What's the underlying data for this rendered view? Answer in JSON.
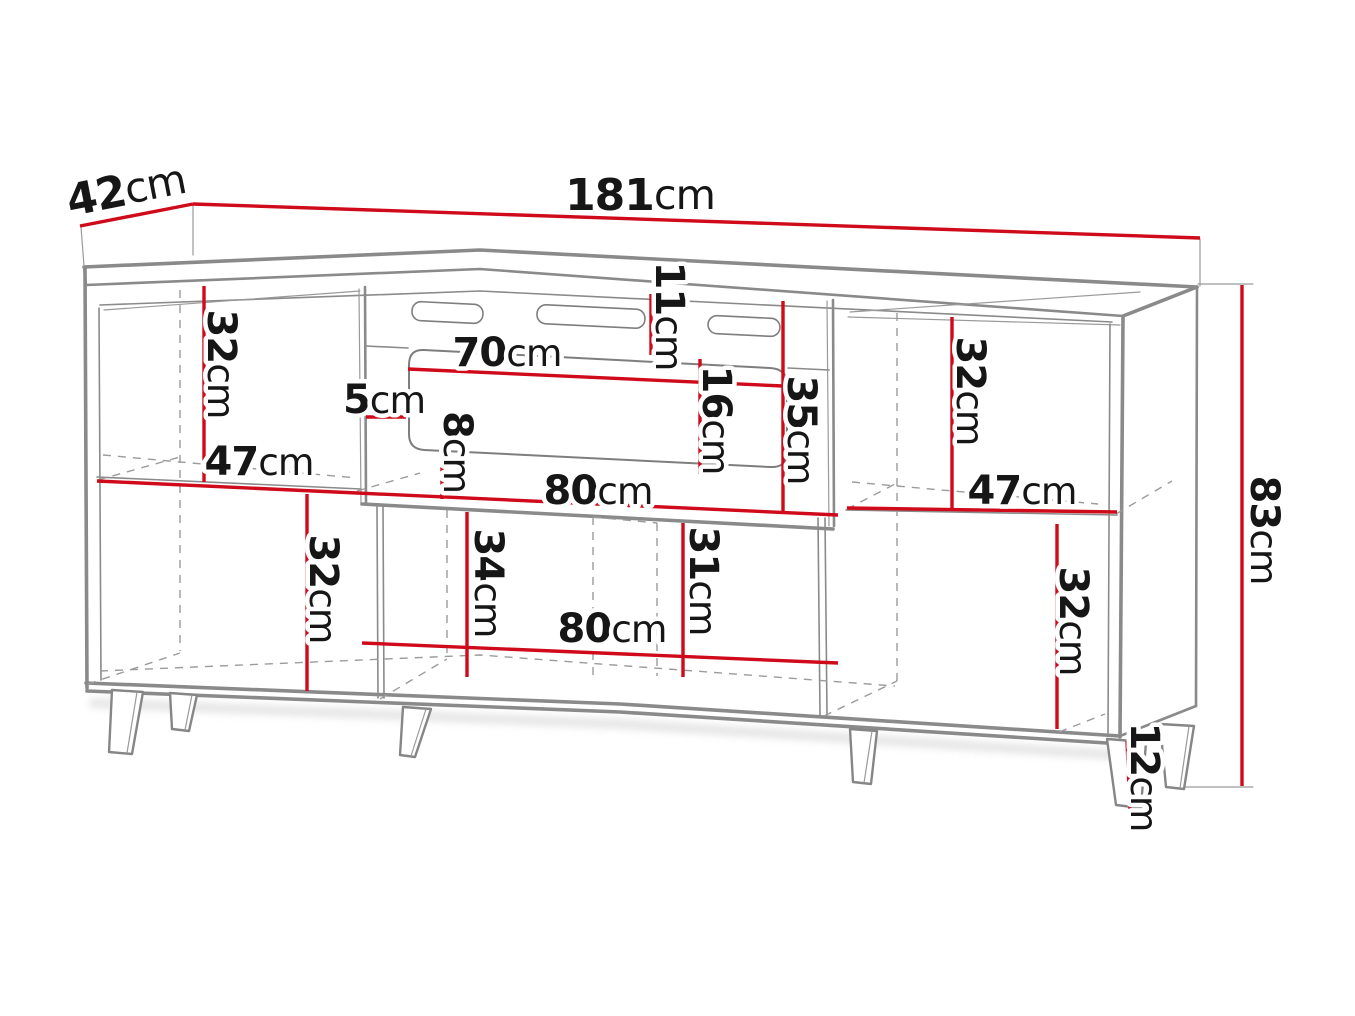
{
  "meta": {
    "type": "furniture-dimension-diagram",
    "subject": "sideboard / TV cabinet with fireplace insert, six tapered legs",
    "unit": "cm",
    "view": "front three-quarter perspective line drawing"
  },
  "colors": {
    "dimension_line": "#cf0a1a",
    "structure_line": "#8a8a8a",
    "label_text": "#161616",
    "background": "#ffffff"
  },
  "overall_dimensions": {
    "width_cm": 181,
    "depth_cm": 42,
    "height_cm": 83,
    "leg_height_cm": 12
  },
  "labels": [
    {
      "id": "depth",
      "value": "42",
      "unit": "cm"
    },
    {
      "id": "width",
      "value": "181",
      "unit": "cm"
    },
    {
      "id": "height",
      "value": "83",
      "unit": "cm"
    },
    {
      "id": "leg-height",
      "value": "12",
      "unit": "cm"
    },
    {
      "id": "left-upper-compartment",
      "value": "32",
      "unit": "cm"
    },
    {
      "id": "left-shelf-width",
      "value": "47",
      "unit": "cm"
    },
    {
      "id": "left-lower-compartment",
      "value": "32",
      "unit": "cm"
    },
    {
      "id": "side-gap",
      "value": "5",
      "unit": "cm"
    },
    {
      "id": "bottom-gap",
      "value": "8",
      "unit": "cm"
    },
    {
      "id": "fireplace-top-width",
      "value": "70",
      "unit": "cm"
    },
    {
      "id": "vent-band-height",
      "value": "11",
      "unit": "cm"
    },
    {
      "id": "fireplace-opening-height",
      "value": "16",
      "unit": "cm"
    },
    {
      "id": "middle-section-height",
      "value": "35",
      "unit": "cm"
    },
    {
      "id": "middle-width-upper",
      "value": "80",
      "unit": "cm"
    },
    {
      "id": "middle-lower-left-height",
      "value": "34",
      "unit": "cm"
    },
    {
      "id": "middle-lower-right-height",
      "value": "31",
      "unit": "cm"
    },
    {
      "id": "middle-width-lower",
      "value": "80",
      "unit": "cm"
    },
    {
      "id": "right-upper-compartment",
      "value": "32",
      "unit": "cm"
    },
    {
      "id": "right-shelf-width",
      "value": "47",
      "unit": "cm"
    },
    {
      "id": "right-lower-compartment",
      "value": "32",
      "unit": "cm"
    }
  ]
}
